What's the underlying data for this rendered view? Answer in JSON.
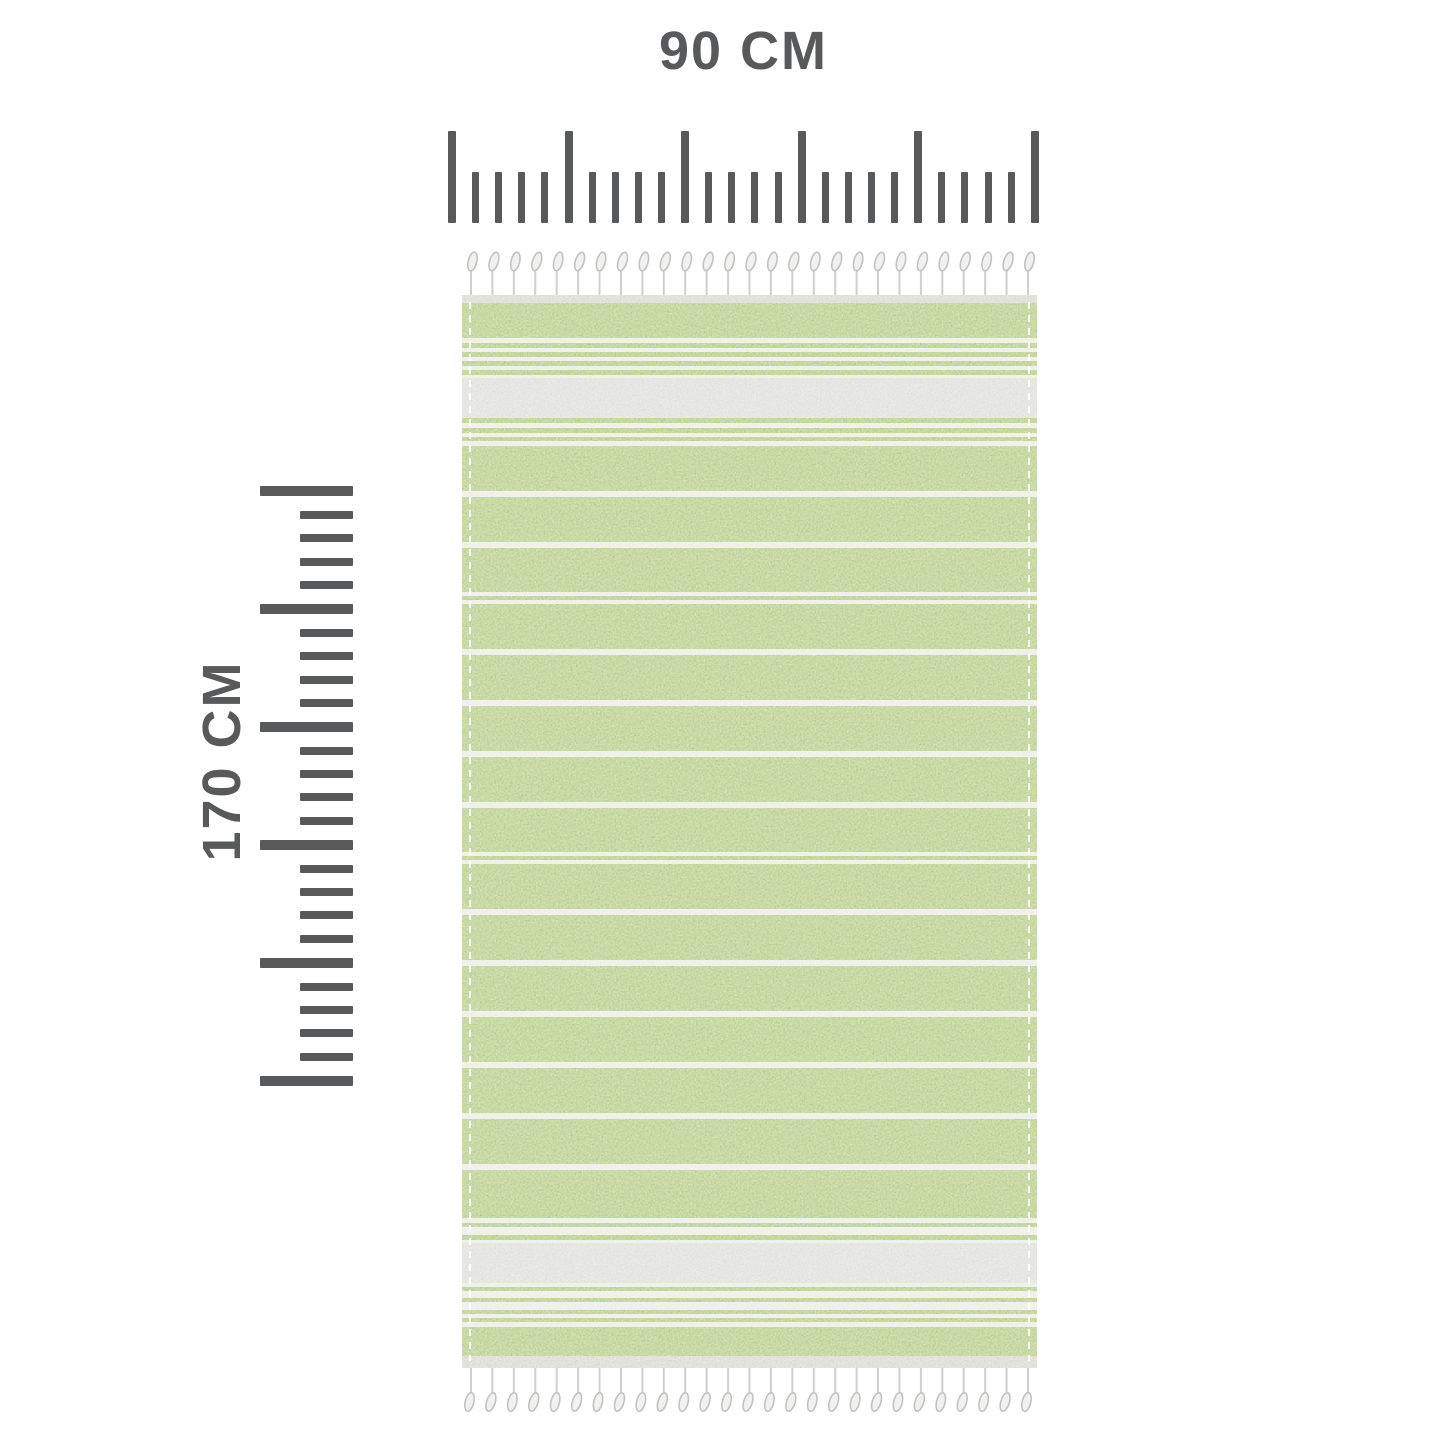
{
  "diagram": {
    "product": "striped beach towel with fringe",
    "background_color": "#ffffff"
  },
  "horizontal_ruler": {
    "label": "90 CM",
    "major_ticks": 6,
    "minor_ticks_per_interval": 4,
    "color": "#58595b"
  },
  "vertical_ruler": {
    "label": "170 CM",
    "major_ticks": 6,
    "minor_ticks_per_interval": 4,
    "color": "#58595b"
  },
  "towel": {
    "colors": {
      "green": "#a8c671",
      "pin": "#a4c368",
      "white": "#edeeea",
      "gray": "#dcddd9",
      "hem": "#d3d4d1"
    },
    "stripes": [
      [
        "hem",
        8
      ],
      [
        "green",
        35
      ],
      [
        "white",
        5
      ],
      [
        "pin",
        5
      ],
      [
        "white",
        4
      ],
      [
        "pin",
        5
      ],
      [
        "white",
        4
      ],
      [
        "pin",
        5
      ],
      [
        "white",
        4
      ],
      [
        "pin",
        5
      ],
      [
        "white",
        3
      ],
      [
        "gray",
        40
      ],
      [
        "pin",
        5
      ],
      [
        "white",
        5
      ],
      [
        "pin",
        5
      ],
      [
        "white",
        4
      ],
      [
        "pin",
        4
      ],
      [
        "white",
        5
      ],
      [
        "green",
        45
      ],
      [
        "white",
        6
      ],
      [
        "green",
        45
      ],
      [
        "white",
        6
      ],
      [
        "green",
        44
      ],
      [
        "white",
        4
      ],
      [
        "pin",
        4
      ],
      [
        "white",
        4
      ],
      [
        "green",
        45
      ],
      [
        "white",
        6
      ],
      [
        "green",
        45
      ],
      [
        "white",
        6
      ],
      [
        "green",
        45
      ],
      [
        "white",
        6
      ],
      [
        "green",
        45
      ],
      [
        "white",
        6
      ],
      [
        "green",
        44
      ],
      [
        "white",
        4
      ],
      [
        "pin",
        4
      ],
      [
        "white",
        4
      ],
      [
        "green",
        45
      ],
      [
        "white",
        6
      ],
      [
        "green",
        45
      ],
      [
        "white",
        6
      ],
      [
        "green",
        45
      ],
      [
        "white",
        6
      ],
      [
        "green",
        45
      ],
      [
        "white",
        6
      ],
      [
        "green",
        45
      ],
      [
        "white",
        6
      ],
      [
        "green",
        45
      ],
      [
        "white",
        6
      ],
      [
        "green",
        45
      ],
      [
        "pin",
        3
      ],
      [
        "white",
        5
      ],
      [
        "pin",
        4
      ],
      [
        "white",
        8
      ],
      [
        "pin",
        5
      ],
      [
        "white",
        3
      ],
      [
        "gray",
        40
      ],
      [
        "white",
        4
      ],
      [
        "pin",
        4
      ],
      [
        "white",
        7
      ],
      [
        "pin",
        4
      ],
      [
        "white",
        8
      ],
      [
        "pin",
        4
      ],
      [
        "white",
        4
      ],
      [
        "pin",
        4
      ],
      [
        "white",
        5
      ],
      [
        "green",
        29
      ],
      [
        "hem",
        12
      ]
    ],
    "fringe": {
      "count": 27,
      "stem_color": "#cfd0ce",
      "knob_fill": "#f1f2f0",
      "knob_stroke": "#c2c3c1"
    }
  }
}
